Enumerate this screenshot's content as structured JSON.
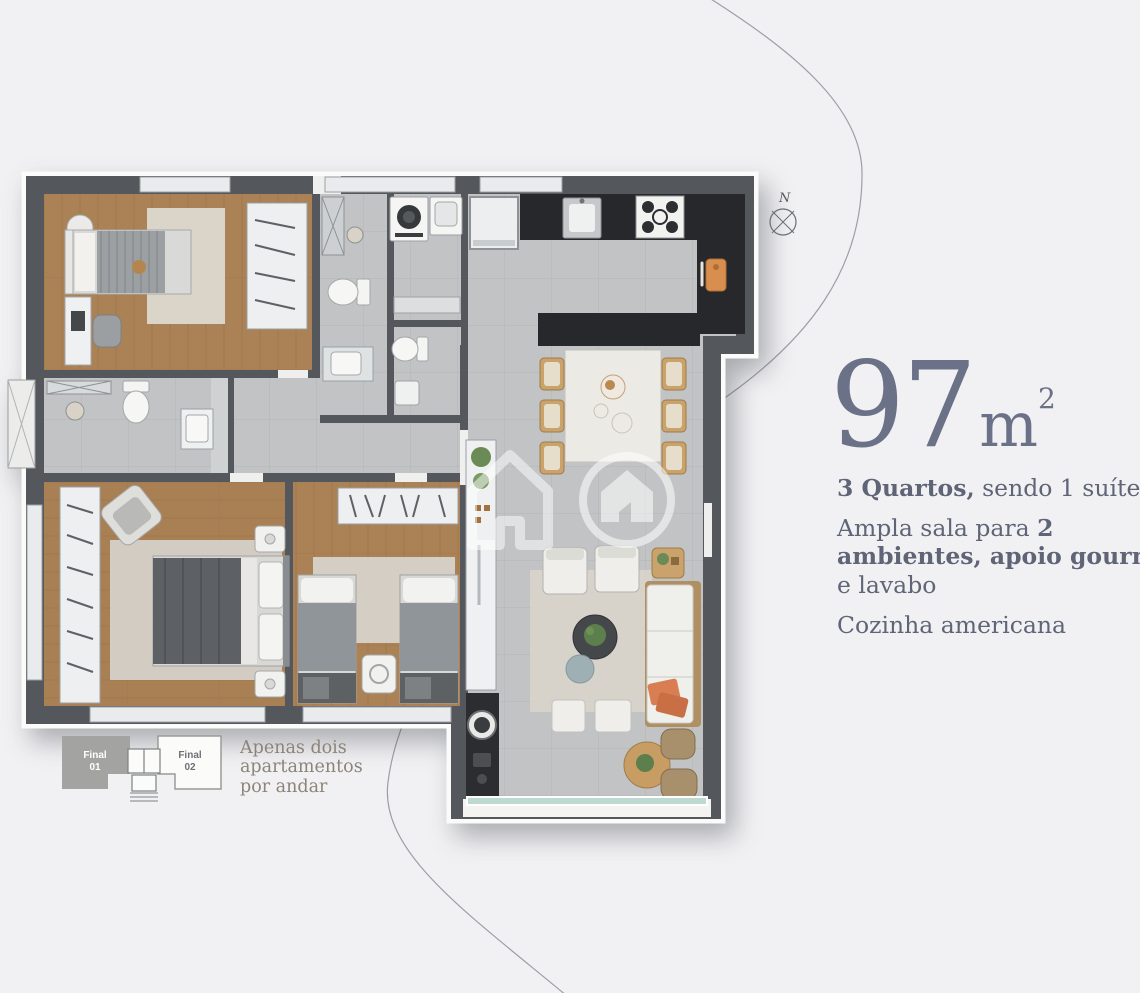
{
  "theme": {
    "bg": "#f1f1f3",
    "headline": "#6b7288",
    "body-text": "#5f6576",
    "caption": "#8b8479",
    "accent-orange": "#d87e52",
    "wall": "#54575b",
    "wood-floor": "#ab8156",
    "tile-floor": "#c1c3c5",
    "counter-dark": "#26282b",
    "balcony-glass": "#bed8d2"
  },
  "headline": {
    "area": "97",
    "unit": "m",
    "exp": "2"
  },
  "features": {
    "l1_bold": "3 Quartos,",
    "l1_rest": " sendo 1 suíte",
    "l2_a": "Ampla sala para ",
    "l2_b": "2 ambientes, apoio gourmet",
    "l2_c": " e lavabo",
    "l3": "Cozinha americana"
  },
  "keyplan": {
    "final01_l1": "Final",
    "final01_l2": "01",
    "final02_l1": "Final",
    "final02_l2": "02",
    "caption_l1": "Apenas dois",
    "caption_l2": "apartamentos",
    "caption_l3": "por andar"
  },
  "compass": {
    "north": "N"
  }
}
